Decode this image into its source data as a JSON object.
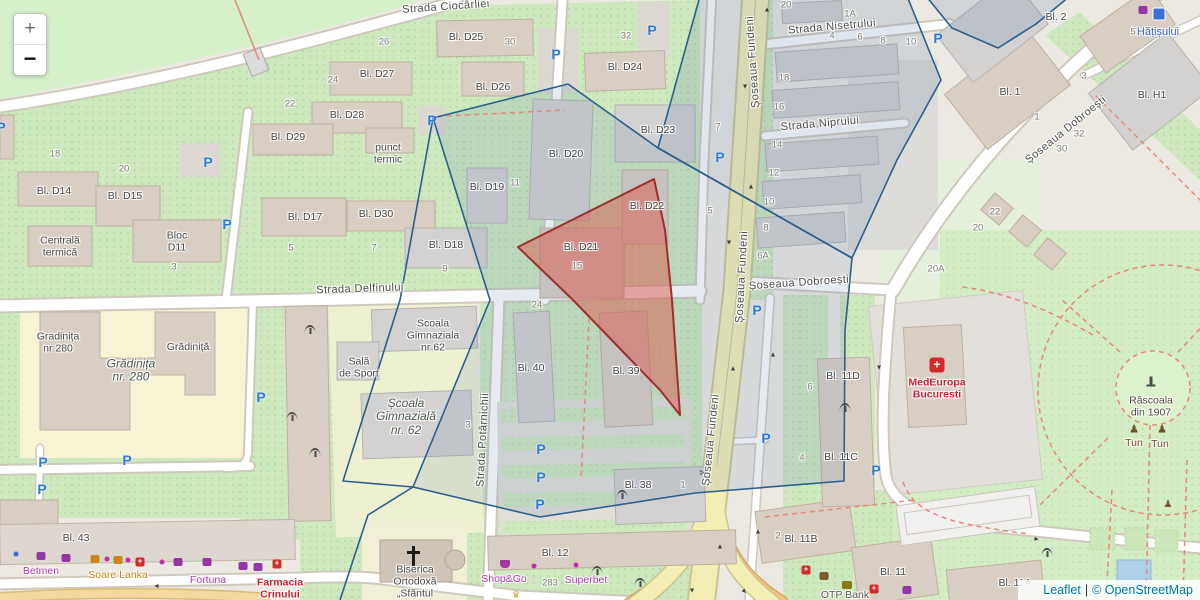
{
  "controls": {
    "zoom_in": "+",
    "zoom_out": "−"
  },
  "attribution": {
    "leaflet": "Leaflet",
    "separator": "|",
    "osm": "© OpenStreetMap"
  },
  "colors": {
    "overlay_blue_stroke": "#2d5f8e",
    "overlay_red_stroke": "#9e2f2e",
    "road_primary": "#f3efb4",
    "parking_blue": "#2f7bd9",
    "poi_magenta": "#b53ab0",
    "poi_red": "#cc2030",
    "park_green": "#d5edc6"
  },
  "icon_glyphs": {
    "parking": "P",
    "arrow": "▲",
    "hospital": "+",
    "cross": "+",
    "tun": "♟",
    "statue": "♟",
    "crown": "♛",
    "scissors": "✂"
  },
  "labels": [
    {
      "t": "Strada Ciocârliei",
      "x": 446,
      "y": 7,
      "c": "st",
      "r": -4,
      "n": "street-strada-ciocarliei"
    },
    {
      "t": "Strada Nisetrului",
      "x": 832,
      "y": 27,
      "c": "st",
      "r": -5,
      "n": "street-strada-nisetrului"
    },
    {
      "t": "Strada Niprului",
      "x": 820,
      "y": 124,
      "c": "st",
      "r": -5,
      "n": "street-strada-niprului"
    },
    {
      "t": "Șoseaua Fundeni",
      "x": 753,
      "y": 62,
      "c": "st",
      "r": -94,
      "n": "street-soseaua-fundeni"
    },
    {
      "t": "Șoseaua Fundeni",
      "x": 742,
      "y": 277,
      "c": "st",
      "r": -87,
      "n": "street-soseaua-fundeni"
    },
    {
      "t": "Șoseaua Fundeni",
      "x": 711,
      "y": 440,
      "c": "st",
      "r": -84,
      "n": "street-soseaua-fundeni"
    },
    {
      "t": "Șoseaua Dobroești",
      "x": 1066,
      "y": 130,
      "c": "st",
      "r": -39,
      "n": "street-soseaua-dobroesti"
    },
    {
      "t": "Șoseaua Dobroești",
      "x": 799,
      "y": 283,
      "c": "st",
      "r": -4,
      "n": "street-soseaua-dobroesti"
    },
    {
      "t": "Strada Delfinului",
      "x": 360,
      "y": 289,
      "c": "st",
      "r": -2,
      "n": "street-strada-delfinului"
    },
    {
      "t": "Strada Potârnichii",
      "x": 483,
      "y": 440,
      "c": "st",
      "r": -87,
      "n": "street-strada-potarnichii"
    },
    {
      "t": "Bl. D25",
      "x": 466,
      "y": 38,
      "c": "bk"
    },
    {
      "t": "Bl. D27",
      "x": 377,
      "y": 75,
      "c": "bk"
    },
    {
      "t": "Bl. D26",
      "x": 493,
      "y": 88,
      "c": "bk"
    },
    {
      "t": "Bl. D24",
      "x": 625,
      "y": 68,
      "c": "bk"
    },
    {
      "t": "Bl. D28",
      "x": 347,
      "y": 116,
      "c": "bk"
    },
    {
      "t": "Bl. D29",
      "x": 288,
      "y": 138,
      "c": "bk"
    },
    {
      "t": "Bl. D23",
      "x": 658,
      "y": 131,
      "c": "bk"
    },
    {
      "t": "Bl. D20",
      "x": 566,
      "y": 155,
      "c": "bk"
    },
    {
      "t": "punct\ntermic",
      "x": 388,
      "y": 154,
      "c": "bk"
    },
    {
      "t": "Bl. D19",
      "x": 487,
      "y": 188,
      "c": "bk"
    },
    {
      "t": "Bl. D14",
      "x": 54,
      "y": 192,
      "c": "bk"
    },
    {
      "t": "Bl. D15",
      "x": 125,
      "y": 197,
      "c": "bk"
    },
    {
      "t": "Bl. D22",
      "x": 647,
      "y": 207,
      "c": "bk"
    },
    {
      "t": "Bl. D17",
      "x": 305,
      "y": 218,
      "c": "bk"
    },
    {
      "t": "Bl. D30",
      "x": 376,
      "y": 215,
      "c": "bk"
    },
    {
      "t": "Bl. D18",
      "x": 446,
      "y": 246,
      "c": "bk"
    },
    {
      "t": "Centrală\ntermică",
      "x": 60,
      "y": 247,
      "c": "bk"
    },
    {
      "t": "Bloc\nD11",
      "x": 177,
      "y": 242,
      "c": "bk"
    },
    {
      "t": "Bl. D21",
      "x": 581,
      "y": 248,
      "c": "bk"
    },
    {
      "t": "Gradinița\nnr 280",
      "x": 58,
      "y": 343,
      "c": "bk"
    },
    {
      "t": "Grădiniță",
      "x": 188,
      "y": 348,
      "c": "bk"
    },
    {
      "t": "Grădinița\nnr. 280",
      "x": 131,
      "y": 371,
      "c": "bki"
    },
    {
      "t": "Scoala\nGimnaziala\nnr 62",
      "x": 433,
      "y": 336,
      "c": "bk"
    },
    {
      "t": "Sală\nde Sport",
      "x": 359,
      "y": 368,
      "c": "bk"
    },
    {
      "t": "Școala\nGimnazială\nnr. 62",
      "x": 406,
      "y": 417,
      "c": "bki"
    },
    {
      "t": "Bl. 40",
      "x": 531,
      "y": 369,
      "c": "bk"
    },
    {
      "t": "Bl. 39",
      "x": 626,
      "y": 372,
      "c": "bk"
    },
    {
      "t": "Bl. 11D",
      "x": 843,
      "y": 377,
      "c": "bk"
    },
    {
      "t": "Bl. 11C",
      "x": 841,
      "y": 458,
      "c": "bk"
    },
    {
      "t": "Bl. 38",
      "x": 638,
      "y": 486,
      "c": "bk"
    },
    {
      "t": "Bl. 12",
      "x": 555,
      "y": 554,
      "c": "bk"
    },
    {
      "t": "Bl. 11B",
      "x": 801,
      "y": 540,
      "c": "bk"
    },
    {
      "t": "Bl. 11",
      "x": 893,
      "y": 573,
      "c": "bk"
    },
    {
      "t": "Bl. 11A",
      "x": 1015,
      "y": 584,
      "c": "bk"
    },
    {
      "t": "Bl. 43",
      "x": 76,
      "y": 539,
      "c": "bk"
    },
    {
      "t": "Bl. 2",
      "x": 1056,
      "y": 18,
      "c": "bk"
    },
    {
      "t": "Bl. 1",
      "x": 1010,
      "y": 93,
      "c": "bk"
    },
    {
      "t": "Bl. H1",
      "x": 1152,
      "y": 96,
      "c": "bk"
    },
    {
      "t": "Biserica\nOrtodoxă\n„Sfântul",
      "x": 415,
      "y": 582,
      "c": "bk",
      "n": "poi-biserica-ortodoxa"
    },
    {
      "t": "MedEuropa\nBucuresti",
      "x": 937,
      "y": 389,
      "c": "poi-red",
      "n": "poi-medeuropa-bucuresti"
    },
    {
      "t": "Hățișului",
      "x": 1158,
      "y": 32,
      "c": "poi-blue",
      "n": "poi-hatisului"
    },
    {
      "t": "Râscoala\ndin 1907",
      "x": 1151,
      "y": 407,
      "c": "poi-dark",
      "n": "poi-rascoala-din-1907"
    },
    {
      "t": "Tun",
      "x": 1134,
      "y": 444,
      "c": "poi-brown",
      "n": "poi-tun"
    },
    {
      "t": "Tun",
      "x": 1160,
      "y": 445,
      "c": "poi-brown",
      "n": "poi-tun"
    },
    {
      "t": "Betmen",
      "x": 41,
      "y": 572,
      "c": "poi-mag",
      "n": "poi-betmen"
    },
    {
      "t": "Soare Lanka",
      "x": 118,
      "y": 576,
      "c": "poi-org",
      "n": "poi-soare-lanka"
    },
    {
      "t": "Fortuna",
      "x": 208,
      "y": 581,
      "c": "poi-mag",
      "n": "poi-fortuna"
    },
    {
      "t": "Farmacia\nCrinului",
      "x": 280,
      "y": 589,
      "c": "poi-red",
      "n": "poi-farmacia-crinului"
    },
    {
      "t": "Shop&Go",
      "x": 504,
      "y": 580,
      "c": "poi-mag",
      "n": "poi-shop-and-go"
    },
    {
      "t": "Superbet",
      "x": 586,
      "y": 581,
      "c": "poi-mag",
      "n": "poi-superbet"
    },
    {
      "t": "283",
      "x": 550,
      "y": 584,
      "c": "nm"
    },
    {
      "t": "OTP Bank",
      "x": 845,
      "y": 596,
      "c": "poi-gray",
      "n": "poi-otp-bank"
    },
    {
      "t": "18",
      "x": 55,
      "y": 155,
      "c": "nm"
    },
    {
      "t": "20",
      "x": 124,
      "y": 170,
      "c": "nm"
    },
    {
      "t": "22",
      "x": 290,
      "y": 105,
      "c": "nm"
    },
    {
      "t": "24",
      "x": 333,
      "y": 81,
      "c": "nm"
    },
    {
      "t": "26",
      "x": 384,
      "y": 43,
      "c": "nm"
    },
    {
      "t": "30",
      "x": 510,
      "y": 43,
      "c": "nm"
    },
    {
      "t": "32",
      "x": 626,
      "y": 37,
      "c": "nm"
    },
    {
      "t": "3",
      "x": 174,
      "y": 268,
      "c": "nm"
    },
    {
      "t": "5",
      "x": 291,
      "y": 249,
      "c": "nm"
    },
    {
      "t": "7",
      "x": 374,
      "y": 249,
      "c": "nm"
    },
    {
      "t": "9",
      "x": 445,
      "y": 270,
      "c": "nm"
    },
    {
      "t": "11",
      "x": 515,
      "y": 184,
      "c": "nm"
    },
    {
      "t": "15",
      "x": 577,
      "y": 267,
      "c": "nm"
    },
    {
      "t": "24",
      "x": 537,
      "y": 306,
      "c": "nm"
    },
    {
      "t": "3",
      "x": 468,
      "y": 426,
      "c": "nm"
    },
    {
      "t": "20",
      "x": 786,
      "y": 6,
      "c": "nm"
    },
    {
      "t": "1A",
      "x": 850,
      "y": 15,
      "c": "nm"
    },
    {
      "t": "4",
      "x": 832,
      "y": 37,
      "c": "nm"
    },
    {
      "t": "6",
      "x": 860,
      "y": 38,
      "c": "nm"
    },
    {
      "t": "8",
      "x": 883,
      "y": 42,
      "c": "nm"
    },
    {
      "t": "10",
      "x": 911,
      "y": 43,
      "c": "nm"
    },
    {
      "t": "18",
      "x": 784,
      "y": 79,
      "c": "nm"
    },
    {
      "t": "16",
      "x": 779,
      "y": 108,
      "c": "nm"
    },
    {
      "t": "14",
      "x": 777,
      "y": 146,
      "c": "nm"
    },
    {
      "t": "12",
      "x": 774,
      "y": 174,
      "c": "nm"
    },
    {
      "t": "7",
      "x": 718,
      "y": 128,
      "c": "nm"
    },
    {
      "t": "5",
      "x": 710,
      "y": 212,
      "c": "nm"
    },
    {
      "t": "10",
      "x": 769,
      "y": 203,
      "c": "nm"
    },
    {
      "t": "8",
      "x": 766,
      "y": 229,
      "c": "nm"
    },
    {
      "t": "6A",
      "x": 763,
      "y": 257,
      "c": "nm"
    },
    {
      "t": "20A",
      "x": 936,
      "y": 270,
      "c": "nm"
    },
    {
      "t": "20",
      "x": 978,
      "y": 229,
      "c": "nm"
    },
    {
      "t": "22",
      "x": 995,
      "y": 213,
      "c": "nm"
    },
    {
      "t": "1",
      "x": 683,
      "y": 486,
      "c": "nm"
    },
    {
      "t": "2",
      "x": 778,
      "y": 537,
      "c": "nm"
    },
    {
      "t": "6",
      "x": 810,
      "y": 388,
      "c": "nm"
    },
    {
      "t": "4",
      "x": 802,
      "y": 459,
      "c": "nm"
    },
    {
      "t": "5",
      "x": 1133,
      "y": 33,
      "c": "nm"
    },
    {
      "t": "3",
      "x": 1084,
      "y": 77,
      "c": "nm"
    },
    {
      "t": "1",
      "x": 1037,
      "y": 118,
      "c": "nm"
    },
    {
      "t": "32",
      "x": 1079,
      "y": 135,
      "c": "nm"
    },
    {
      "t": "30",
      "x": 1062,
      "y": 150,
      "c": "nm"
    }
  ],
  "icons": [
    {
      "ty": "parking",
      "x": 208,
      "y": 162
    },
    {
      "ty": "parking",
      "x": 1,
      "y": 127
    },
    {
      "ty": "parking",
      "x": 227,
      "y": 224
    },
    {
      "ty": "parking",
      "x": 556,
      "y": 54
    },
    {
      "ty": "parking",
      "x": 652,
      "y": 30
    },
    {
      "ty": "parking",
      "x": 938,
      "y": 38
    },
    {
      "ty": "parking",
      "x": 720,
      "y": 157
    },
    {
      "ty": "parking",
      "x": 757,
      "y": 310
    },
    {
      "ty": "parking",
      "x": 766,
      "y": 438
    },
    {
      "ty": "parking",
      "x": 876,
      "y": 470
    },
    {
      "ty": "parking",
      "x": 261,
      "y": 397
    },
    {
      "ty": "parking",
      "x": 127,
      "y": 460
    },
    {
      "ty": "parking",
      "x": 43,
      "y": 462
    },
    {
      "ty": "parking",
      "x": 42,
      "y": 489
    },
    {
      "ty": "parking",
      "x": 541,
      "y": 449
    },
    {
      "ty": "parking",
      "x": 541,
      "y": 477
    },
    {
      "ty": "parking",
      "x": 540,
      "y": 504
    },
    {
      "ty": "parking",
      "x": 432,
      "y": 120
    },
    {
      "ty": "antenna",
      "x": 310,
      "y": 330
    },
    {
      "ty": "antenna",
      "x": 292,
      "y": 417
    },
    {
      "ty": "antenna",
      "x": 315,
      "y": 453
    },
    {
      "ty": "antenna",
      "x": 845,
      "y": 408
    },
    {
      "ty": "antenna",
      "x": 622,
      "y": 495
    },
    {
      "ty": "antenna",
      "x": 597,
      "y": 571
    },
    {
      "ty": "antenna",
      "x": 640,
      "y": 583
    },
    {
      "ty": "antenna",
      "x": 1047,
      "y": 553
    },
    {
      "ty": "arrow",
      "x": 767,
      "y": 10,
      "r": 0
    },
    {
      "ty": "arrow",
      "x": 751,
      "y": 187,
      "r": 0
    },
    {
      "ty": "arrow",
      "x": 733,
      "y": 369,
      "r": 0
    },
    {
      "ty": "arrow",
      "x": 773,
      "y": 355,
      "r": 0
    },
    {
      "ty": "arrow",
      "x": 720,
      "y": 547,
      "r": 0
    },
    {
      "ty": "arrow",
      "x": 758,
      "y": 532,
      "r": 0
    },
    {
      "ty": "arrow",
      "x": 745,
      "y": 86,
      "r": 180
    },
    {
      "ty": "arrow",
      "x": 729,
      "y": 242,
      "r": 180
    },
    {
      "ty": "arrow",
      "x": 879,
      "y": 367,
      "r": 180
    },
    {
      "ty": "arrow",
      "x": 692,
      "y": 590,
      "r": 180
    },
    {
      "ty": "arrow",
      "x": 157,
      "y": 586,
      "r": 270
    },
    {
      "ty": "arrow",
      "x": 1036,
      "y": 539,
      "r": 100
    },
    {
      "ty": "arrow",
      "x": 744,
      "y": 591,
      "r": 140
    },
    {
      "ty": "hospital",
      "x": 937,
      "y": 365
    },
    {
      "ty": "cross-red",
      "x": 140,
      "y": 562
    },
    {
      "ty": "cross-red",
      "x": 277,
      "y": 564
    },
    {
      "ty": "cross-red",
      "x": 806,
      "y": 570
    },
    {
      "ty": "cross-red",
      "x": 874,
      "y": 589
    },
    {
      "ty": "monument",
      "x": 1151,
      "y": 381
    },
    {
      "ty": "tun",
      "x": 1134,
      "y": 430
    },
    {
      "ty": "tun",
      "x": 1162,
      "y": 430
    },
    {
      "ty": "statue",
      "x": 1168,
      "y": 505
    },
    {
      "ty": "crown",
      "x": 516,
      "y": 595
    },
    {
      "ty": "scissors",
      "x": 704,
      "y": 474
    },
    {
      "ty": "basket",
      "x": 505,
      "y": 564
    },
    {
      "ty": "dot-blue",
      "x": 16,
      "y": 554
    },
    {
      "ty": "dot-mag",
      "x": 107,
      "y": 559
    },
    {
      "ty": "dot-mag",
      "x": 128,
      "y": 560
    },
    {
      "ty": "dot-mag",
      "x": 162,
      "y": 562
    },
    {
      "ty": "dot-mag",
      "x": 534,
      "y": 566
    },
    {
      "ty": "dot-mag",
      "x": 576,
      "y": 565
    },
    {
      "ty": "sq-purple",
      "x": 41,
      "y": 556
    },
    {
      "ty": "sq-purple",
      "x": 66,
      "y": 558
    },
    {
      "ty": "sq-purple",
      "x": 178,
      "y": 562
    },
    {
      "ty": "sq-purple",
      "x": 207,
      "y": 562
    },
    {
      "ty": "sq-purple",
      "x": 243,
      "y": 566
    },
    {
      "ty": "sq-purple",
      "x": 258,
      "y": 567
    },
    {
      "ty": "sq-purple",
      "x": 907,
      "y": 590
    },
    {
      "ty": "sq-purple",
      "x": 1143,
      "y": 10
    },
    {
      "ty": "sq-orange",
      "x": 95,
      "y": 559
    },
    {
      "ty": "sq-orange",
      "x": 118,
      "y": 560
    },
    {
      "ty": "sq-brown",
      "x": 824,
      "y": 576
    },
    {
      "ty": "sq-olive",
      "x": 847,
      "y": 585
    },
    {
      "ty": "transit",
      "x": 1159,
      "y": 14
    },
    {
      "ty": "church-cross",
      "x": 413,
      "y": 556
    }
  ]
}
